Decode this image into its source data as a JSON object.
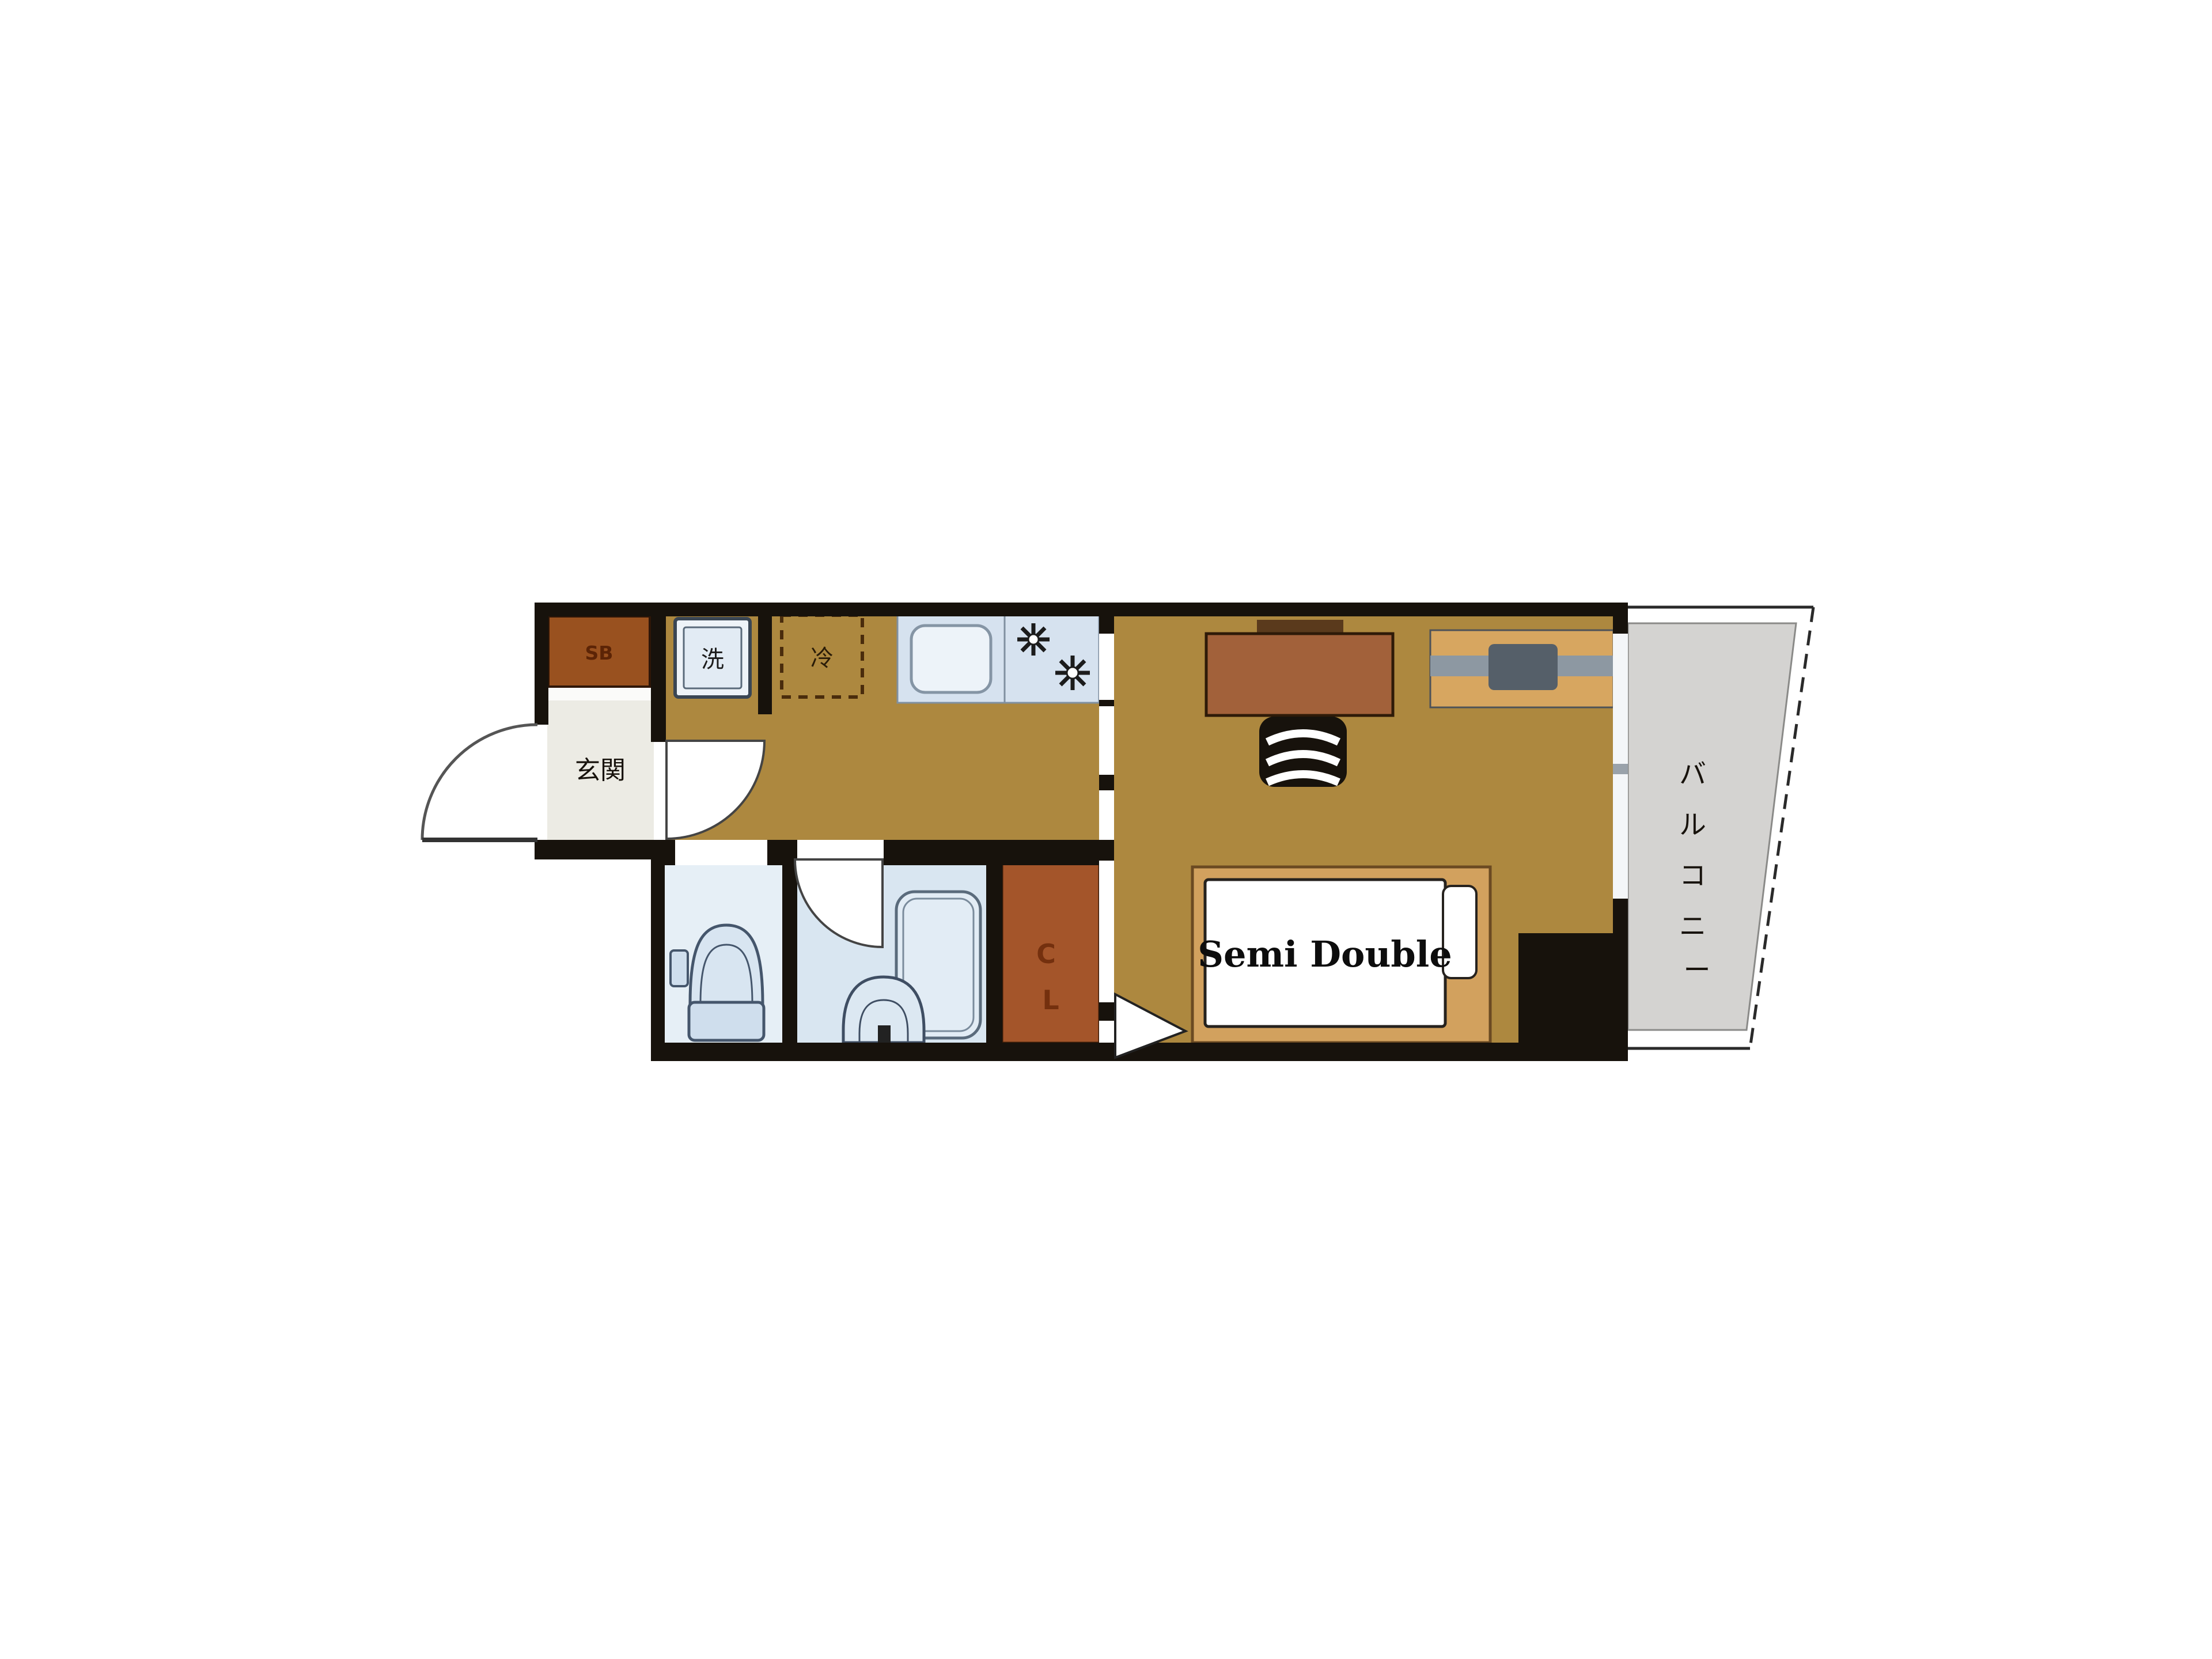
{
  "floorplan": {
    "type": "apartment-floor-plan",
    "labels": {
      "shoe_box": "SB",
      "entrance": "玄関",
      "washing_machine": "洗",
      "refrigerator": "冷",
      "closet_chars": [
        "C",
        "L"
      ],
      "bed": "Semi Double",
      "balcony": "バルコニー",
      "balcony_chars": [
        "バ",
        "ル",
        "コ",
        "ニ",
        "ー"
      ]
    },
    "rooms": [
      {
        "name": "entrance",
        "label": "玄関"
      },
      {
        "name": "kitchen-corridor",
        "label": ""
      },
      {
        "name": "toilet",
        "label": ""
      },
      {
        "name": "bathroom",
        "label": ""
      },
      {
        "name": "closet",
        "label": "CL"
      },
      {
        "name": "bedroom",
        "label": "Semi Double bed room"
      },
      {
        "name": "balcony",
        "label": "バルコニー"
      }
    ],
    "colors": {
      "wall": "#17120c",
      "floor_tan": "#ad883f",
      "entrance_floor": "#ecebe4",
      "shoe_box_brown": "#99511f",
      "closet_brown": "#a4552a",
      "desk_brown": "#a2613a",
      "tv_board_tan": "#d7a660",
      "bed_frame_tan": "#d2a15e",
      "mattress_white": "#ffffff",
      "fixture_blue": "#d6e2ef",
      "toilet_floor": "#e6eff6",
      "bath_floor": "#d9e6f1",
      "balcony_gray": "#d4d3d1",
      "text_black": "#17120c",
      "sb_text": "#5c2406",
      "cl_text": "#74300e"
    }
  }
}
